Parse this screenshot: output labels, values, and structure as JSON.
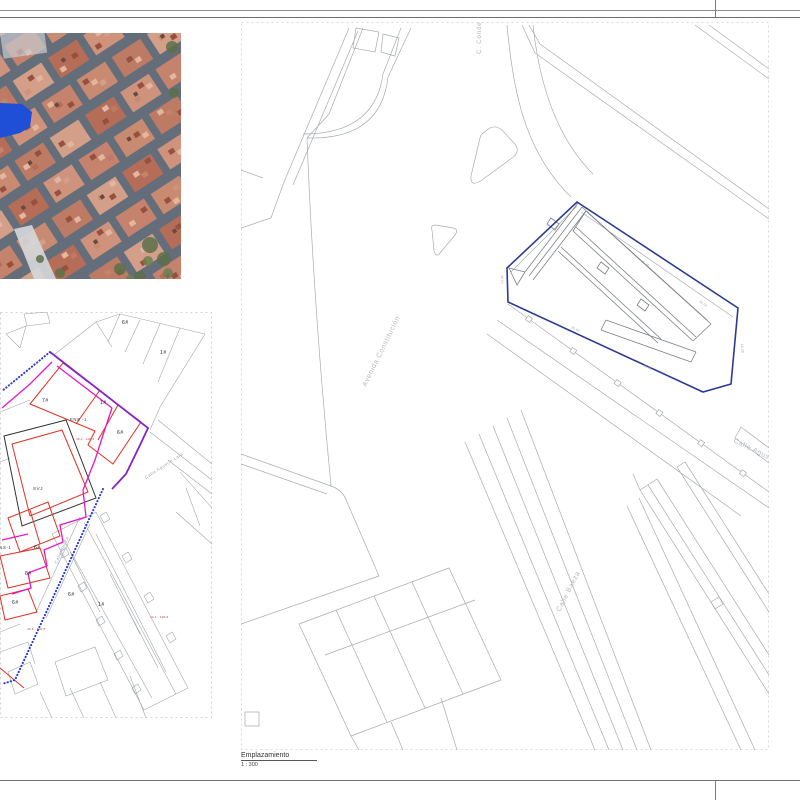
{
  "caption": {
    "title": "Emplazamiento",
    "scale": "1 : 300"
  },
  "colors": {
    "parcel_blue": "#2c3a94",
    "boundary_blue_dotted": "#2a3bd0",
    "boundary_purple": "#8422c9",
    "boundary_magenta": "#e518c8",
    "parcel_red": "#e03022",
    "svj_black": "#333333",
    "cad_gray": "#a6abb0",
    "label_gray": "#b4b8bd",
    "aerial_highlight": "#1e4fd6"
  },
  "aerial": {
    "base": "#646d7a",
    "roof_palette": [
      "#c5826d",
      "#cf927c",
      "#b66d58",
      "#d39f89",
      "#bd7a64",
      "#c98a72"
    ],
    "roof_dark": "#96503f",
    "roof_light": "#e3b6a0",
    "green": "#5c7049",
    "road_light": "#d5d8db"
  },
  "left_plan": {
    "labels": [
      {
        "text": "6#",
        "x": 122,
        "y": 12,
        "rot": 0,
        "size": 5,
        "color": "#222222"
      },
      {
        "text": "1#",
        "x": 160,
        "y": 42,
        "rot": 0,
        "size": 5,
        "color": "#222222"
      },
      {
        "text": "7#",
        "x": 42,
        "y": 90,
        "rot": 0,
        "size": 5,
        "color": "#222222"
      },
      {
        "text": "1#",
        "x": 100,
        "y": 92,
        "rot": 0,
        "size": 5,
        "color": "#222222"
      },
      {
        "text": "ENS -1",
        "x": 70,
        "y": 109,
        "rot": 0,
        "size": 4.2,
        "color": "#333333"
      },
      {
        "text": "6#",
        "x": 117,
        "y": 122,
        "rot": 0,
        "size": 5,
        "color": "#222222"
      },
      {
        "text": "SVJ",
        "x": 33,
        "y": 178,
        "rot": 0,
        "size": 4.5,
        "color": "#333333"
      },
      {
        "text": "ENS-1",
        "x": -4,
        "y": 237,
        "rot": 0,
        "size": 4.2,
        "color": "#333333"
      },
      {
        "text": "6#",
        "x": 34,
        "y": 237,
        "rot": 0,
        "size": 5,
        "color": "#222222"
      },
      {
        "text": "6#",
        "x": 25,
        "y": 263,
        "rot": 0,
        "size": 5,
        "color": "#222222"
      },
      {
        "text": "6#",
        "x": 12,
        "y": 292,
        "rot": 0,
        "size": 5,
        "color": "#222222"
      },
      {
        "text": "6#",
        "x": 68,
        "y": 284,
        "rot": 0,
        "size": 5,
        "color": "#222222"
      },
      {
        "text": "1#",
        "x": 98,
        "y": 294,
        "rot": 0,
        "size": 5,
        "color": "#222222"
      },
      {
        "text": "Calle   Agustín   Lara",
        "x": 146,
        "y": 167,
        "rot": -33,
        "size": 4.2,
        "color": "#9aa0a6"
      },
      {
        "text": "Calle   Baeza",
        "x": 57,
        "y": 252,
        "rot": -66,
        "size": 4.2,
        "color": "#9aa0a6"
      }
    ],
    "annotations": [
      {
        "text": "46.4 - 100.9",
        "x": 76,
        "y": 128,
        "rot": 0,
        "size": 3,
        "color": "#cc3333"
      },
      {
        "text": "44.1 - 100.9",
        "x": 150,
        "y": 306,
        "rot": 0,
        "size": 3,
        "color": "#cc3333"
      },
      {
        "text": "43.6 - 100.8",
        "x": 27,
        "y": 318,
        "rot": 0,
        "size": 3,
        "color": "#cc3333"
      }
    ]
  },
  "right_plan": {
    "street_labels": [
      {
        "text": "Avenida  Constitución",
        "x": 125,
        "y": 365,
        "rot": -64,
        "size": 7,
        "color": "#b4b8bd"
      },
      {
        "text": "C. Conde L",
        "x": 240,
        "y": 32,
        "rot": -90,
        "size": 6.5,
        "color": "#b4b8bd"
      },
      {
        "text": "Calle   Agustín   Lara",
        "x": 492,
        "y": 420,
        "rot": 26,
        "size": 7,
        "color": "#b4b8bd"
      },
      {
        "text": "Calle   Baeza",
        "x": 319,
        "y": 590,
        "rot": -63,
        "size": 7,
        "color": "#b4b8bd"
      }
    ],
    "dim_labels": [
      {
        "text": "25.36",
        "x": 400,
        "y": 240,
        "rot": 33,
        "size": 3.2,
        "color": "#9aa0a6"
      },
      {
        "text": "30.24",
        "x": 458,
        "y": 280,
        "rot": 33,
        "size": 3.2,
        "color": "#9aa0a6"
      },
      {
        "text": "13.40",
        "x": 262,
        "y": 262,
        "rot": -88,
        "size": 3.2,
        "color": "#9aa0a6"
      },
      {
        "text": "25.60",
        "x": 330,
        "y": 306,
        "rot": 27,
        "size": 3.2,
        "color": "#9aa0a6"
      },
      {
        "text": "19.95",
        "x": 402,
        "y": 344,
        "rot": 27,
        "size": 3.2,
        "color": "#9aa0a6"
      },
      {
        "text": "16.20",
        "x": 500,
        "y": 322,
        "rot": 86,
        "size": 3.2,
        "color": "#9aa0a6"
      }
    ]
  }
}
